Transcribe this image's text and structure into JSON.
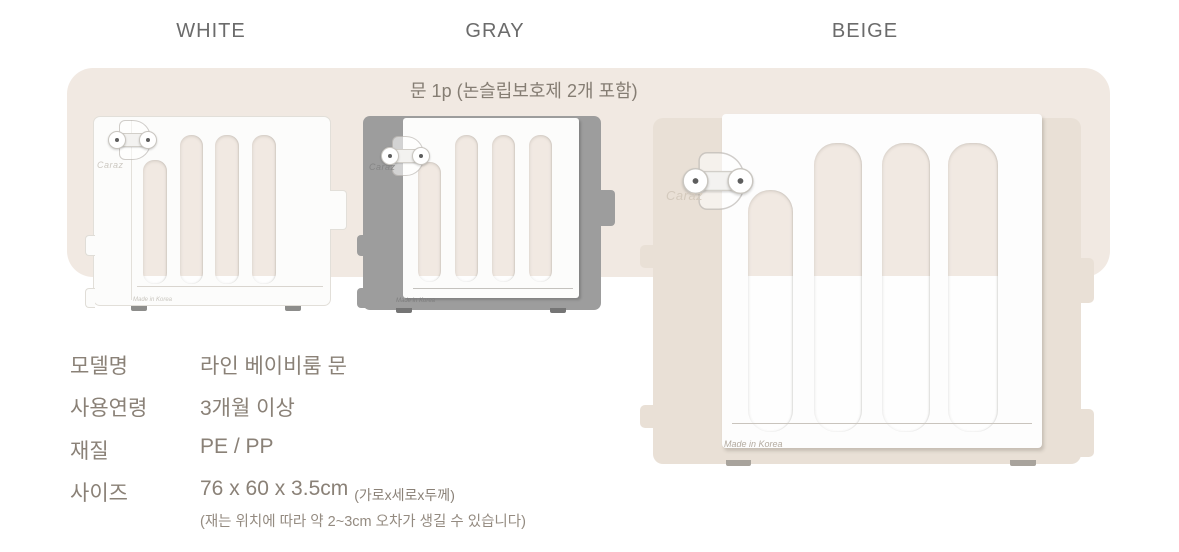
{
  "colors": {
    "banner_bg": "#f1e9e2",
    "white_frame": "#fcfcfb",
    "gray_frame": "#9d9d9d",
    "beige_frame": "#e9e0d6",
    "door_white": "#fdfdfd",
    "spec_text": "#8a8177",
    "label_text": "#6b6b6b"
  },
  "color_labels": [
    {
      "id": "white",
      "label": "WHITE"
    },
    {
      "id": "gray",
      "label": "GRAY"
    },
    {
      "id": "beige",
      "label": "BEIGE"
    }
  ],
  "banner": {
    "text": "문 1p (논슬립보호제 2개 포함)"
  },
  "products": [
    {
      "color": "WHITE",
      "brand": "Caraz",
      "origin": "Made in Korea"
    },
    {
      "color": "GRAY",
      "brand": "Caraz",
      "origin": "Made in Korea"
    },
    {
      "color": "BEIGE",
      "brand": "Caraz",
      "origin": "Made in Korea"
    }
  ],
  "specs": {
    "rows": [
      {
        "label": "모델명",
        "value": "라인 베이비룸 문"
      },
      {
        "label": "사용연령",
        "value": "3개월 이상"
      },
      {
        "label": "재질",
        "value": "PE / PP"
      },
      {
        "label": "사이즈",
        "value": "76 x 60 x 3.5cm",
        "value_note": "(가로x세로x두께)"
      }
    ],
    "caption": "(재는 위치에 따라 약 2~3cm 오차가 생길 수 있습니다)"
  }
}
